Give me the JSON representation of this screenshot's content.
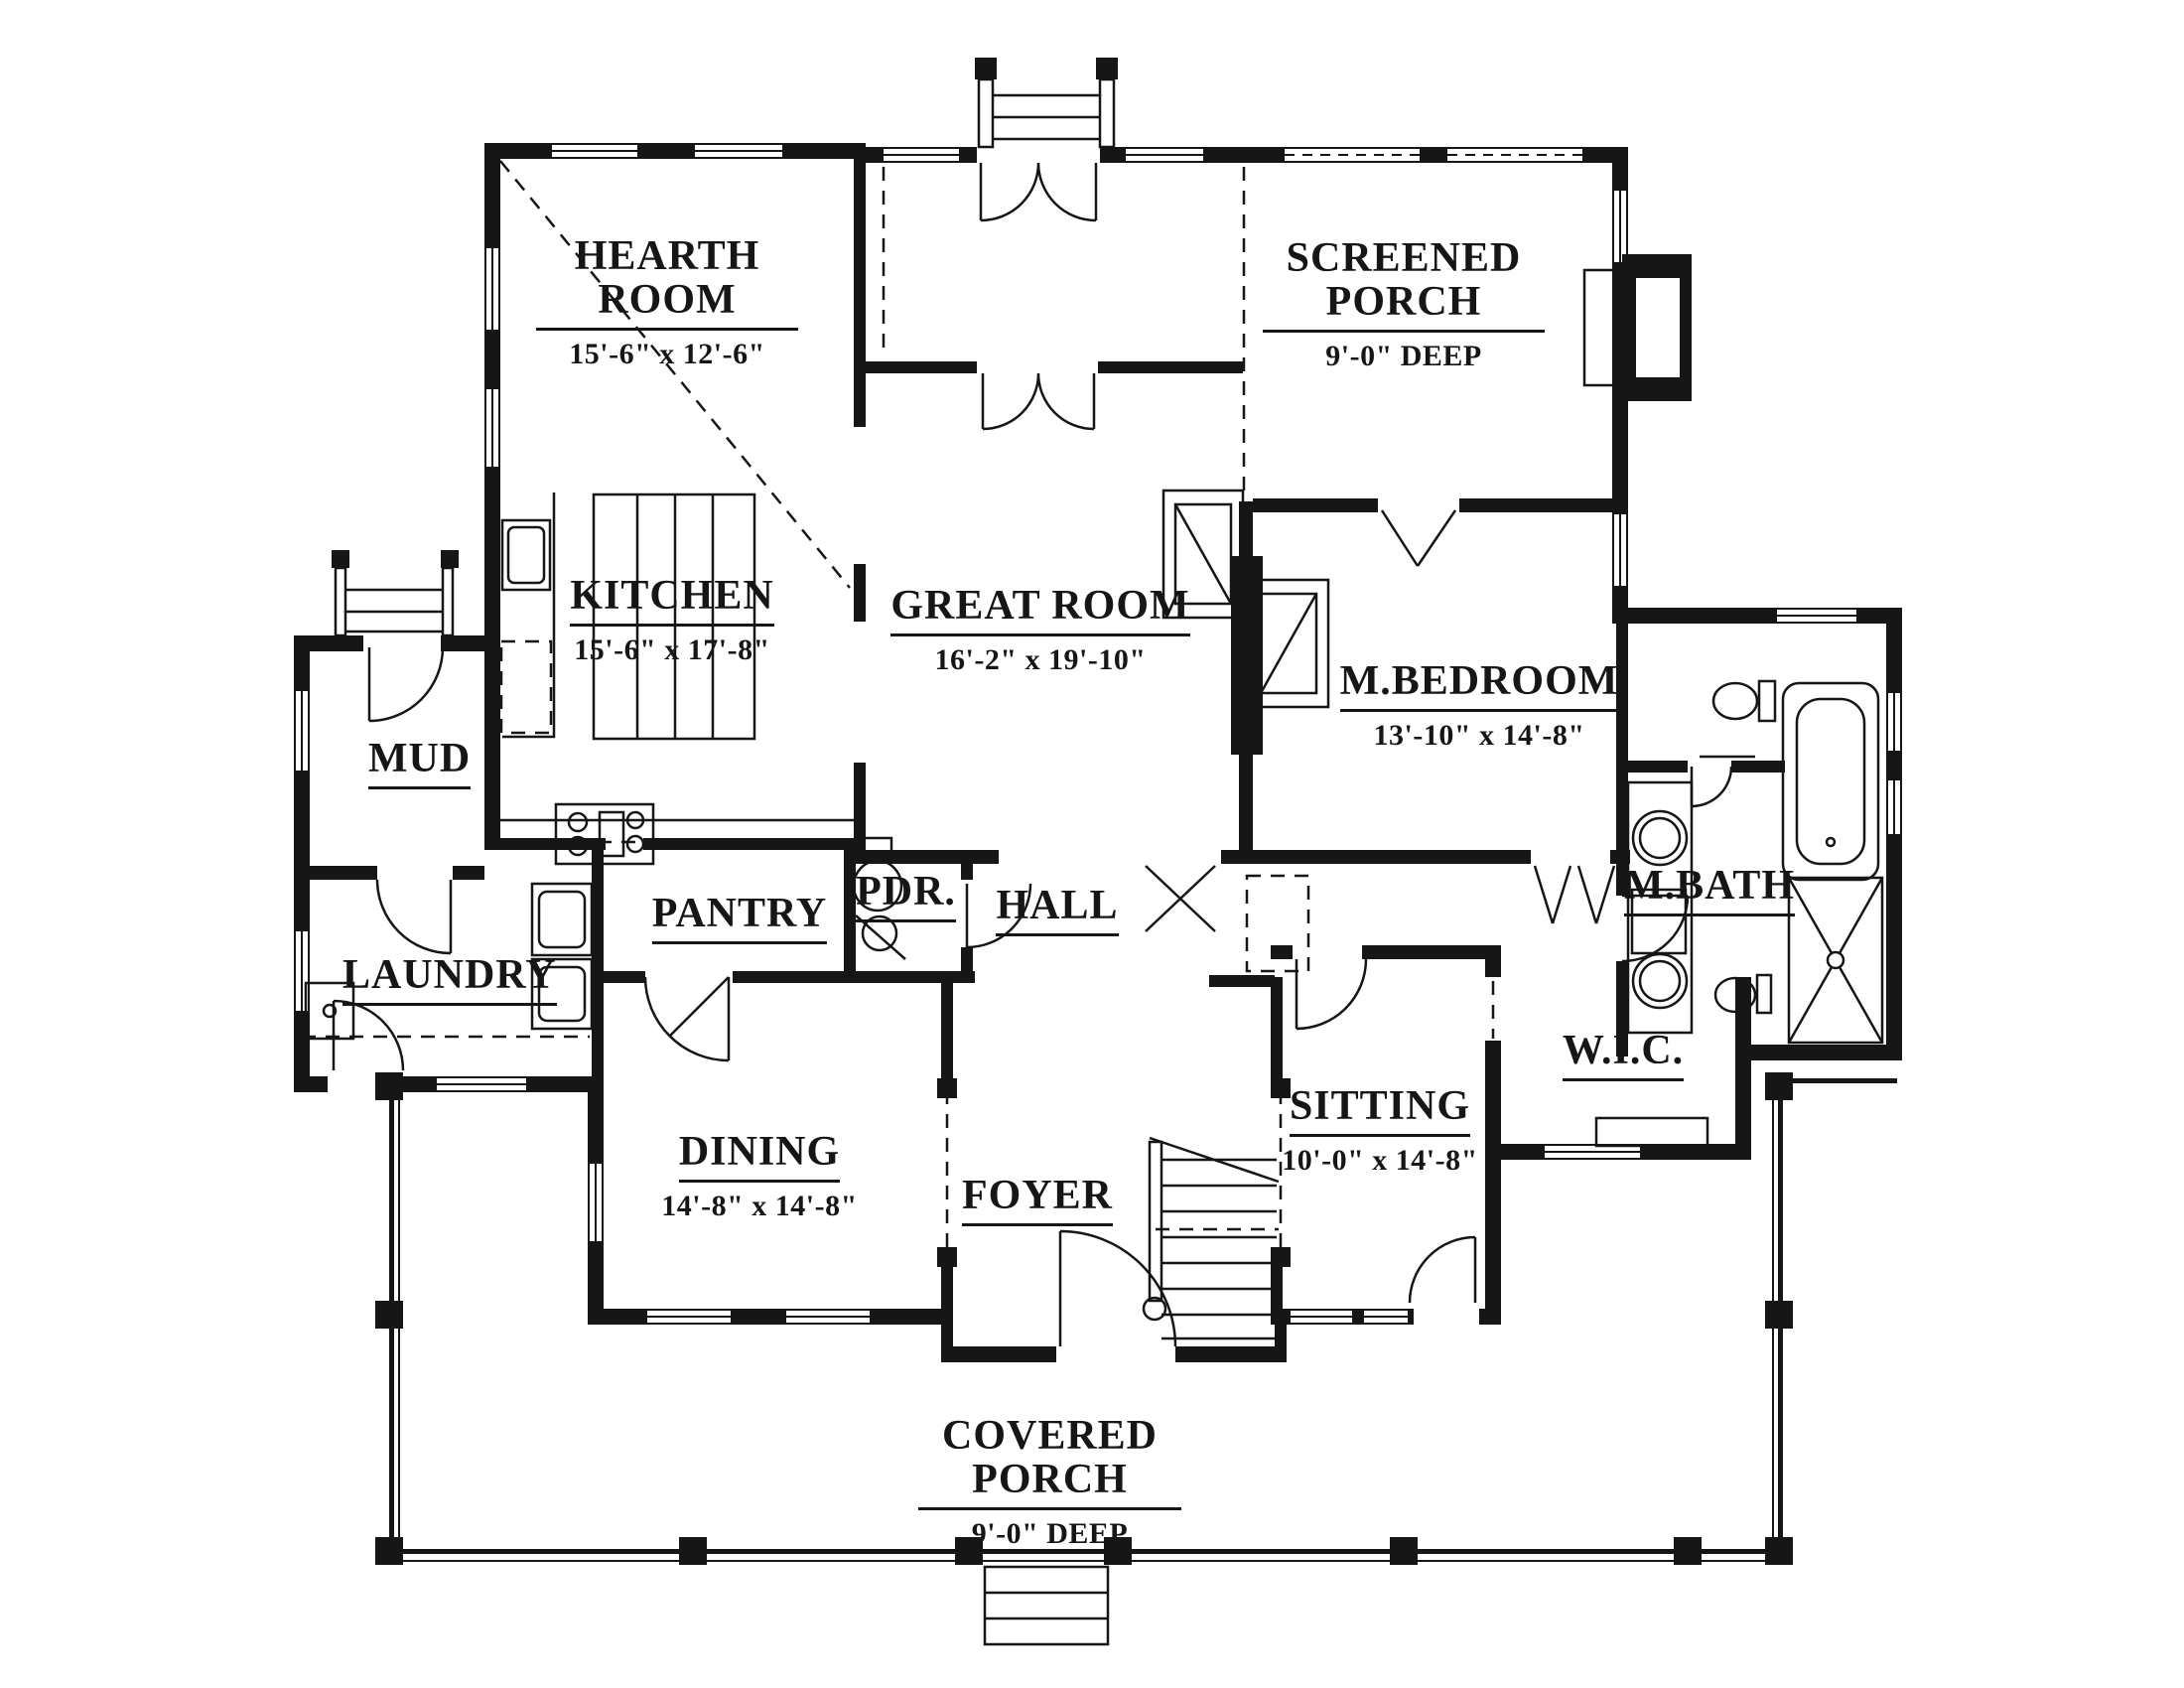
{
  "colors": {
    "wall": "#161616",
    "background": "#ffffff"
  },
  "rooms": [
    {
      "key": "hearth",
      "name": "HEARTH ROOM",
      "dims": "15'-6\" x 12'-6\""
    },
    {
      "key": "screened",
      "name": "SCREENED PORCH",
      "dims": "9'-0\" DEEP"
    },
    {
      "key": "kitchen",
      "name": "KITCHEN",
      "dims": "15'-6\" x 17'-8\""
    },
    {
      "key": "great",
      "name": "GREAT ROOM",
      "dims": "16'-2\" x 19'-10\""
    },
    {
      "key": "mbedroom",
      "name": "M.BEDROOM",
      "dims": "13'-10\" x 14'-8\""
    },
    {
      "key": "mud",
      "name": "MUD"
    },
    {
      "key": "pantry",
      "name": "PANTRY"
    },
    {
      "key": "pdr",
      "name": "PDR."
    },
    {
      "key": "hall",
      "name": "HALL"
    },
    {
      "key": "mbath",
      "name": "M.BATH"
    },
    {
      "key": "laundry",
      "name": "LAUNDRY"
    },
    {
      "key": "dining",
      "name": "DINING",
      "dims": "14'-8\" x 14'-8\""
    },
    {
      "key": "foyer",
      "name": "FOYER"
    },
    {
      "key": "sitting",
      "name": "SITTING",
      "dims": "10'-0\" x 14'-8\""
    },
    {
      "key": "wic",
      "name": "W.I.C."
    },
    {
      "key": "cporch",
      "name": "COVERED PORCH",
      "dims": "9'-0\" DEEP"
    }
  ]
}
